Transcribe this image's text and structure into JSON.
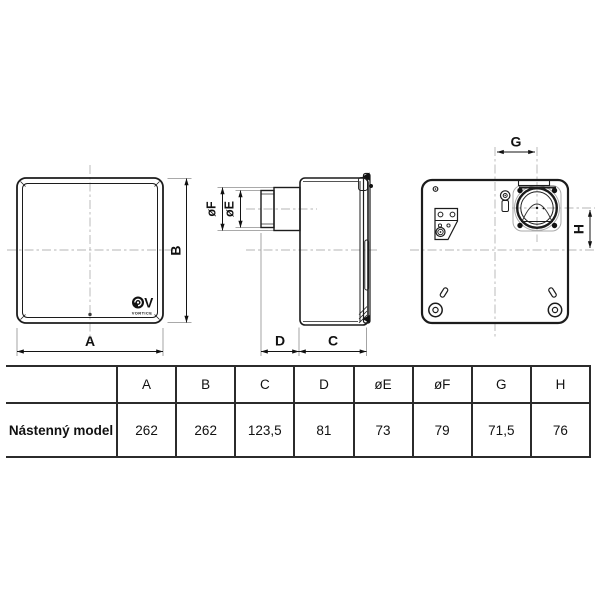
{
  "drawing": {
    "labels": {
      "a": "A",
      "b": "B",
      "c": "C",
      "d": "D",
      "e": "øE",
      "f": "øF",
      "g": "G",
      "h": "H"
    },
    "logo": {
      "brand": "VORTICE"
    }
  },
  "table": {
    "columns": [
      "A",
      "B",
      "C",
      "D",
      "øE",
      "øF",
      "G",
      "H"
    ],
    "rows": [
      {
        "label": "Nástenný model",
        "values": [
          "262",
          "262",
          "123,5",
          "81",
          "73",
          "79",
          "71,5",
          "76"
        ]
      }
    ]
  },
  "colors": {
    "line": "#1c1c1c",
    "centerline": "#b4b4b4",
    "light_line": "#8d8d8d",
    "background": "#ffffff"
  }
}
